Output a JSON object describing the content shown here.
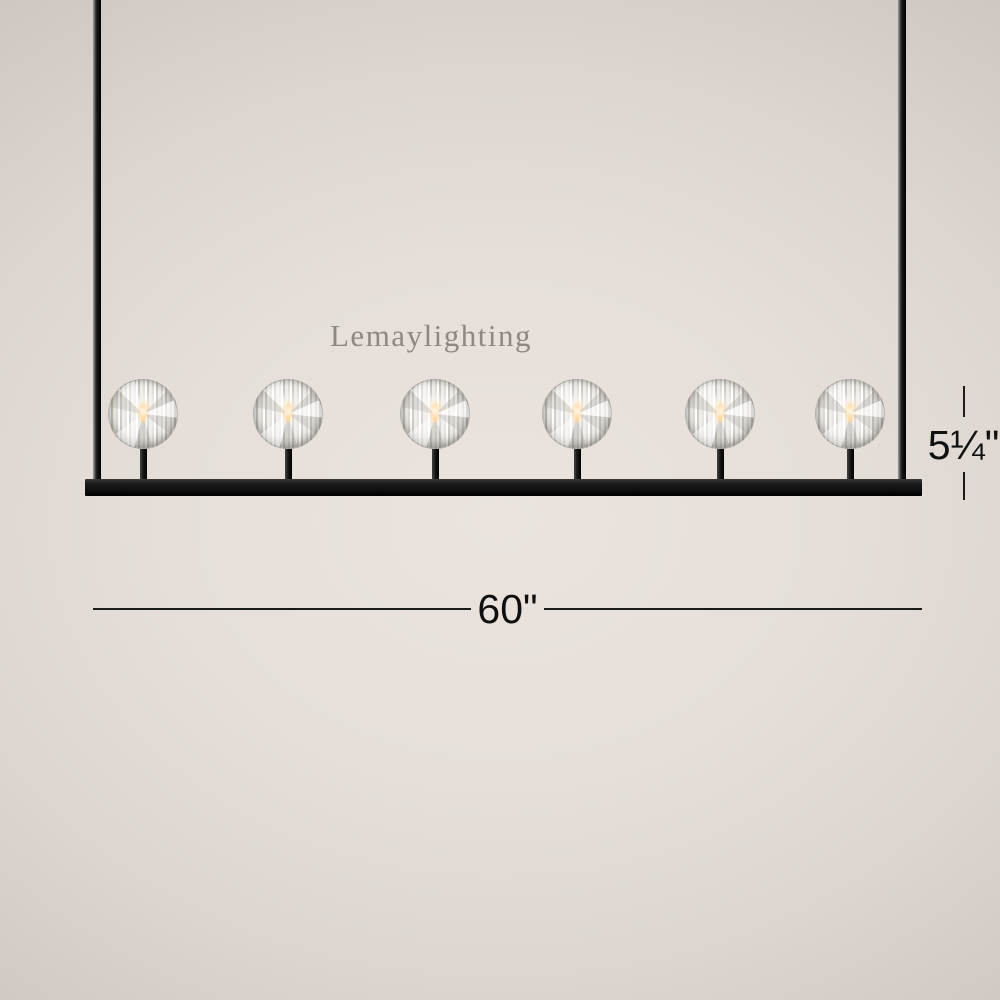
{
  "watermark": {
    "text": "Lemaylighting"
  },
  "dimensions": {
    "width_label": "60\"",
    "height_label": "5¼\""
  },
  "product": {
    "light_count": 6,
    "fixture_type": "linear crystal ball chandelier"
  },
  "colors": {
    "frame": "#111111",
    "background_center": "#ebe4de",
    "background_edge": "#c8c1bb",
    "bulb_glow": "#ffd9a0",
    "annotation_text": "#101010",
    "watermark_text": "#8d8882"
  }
}
